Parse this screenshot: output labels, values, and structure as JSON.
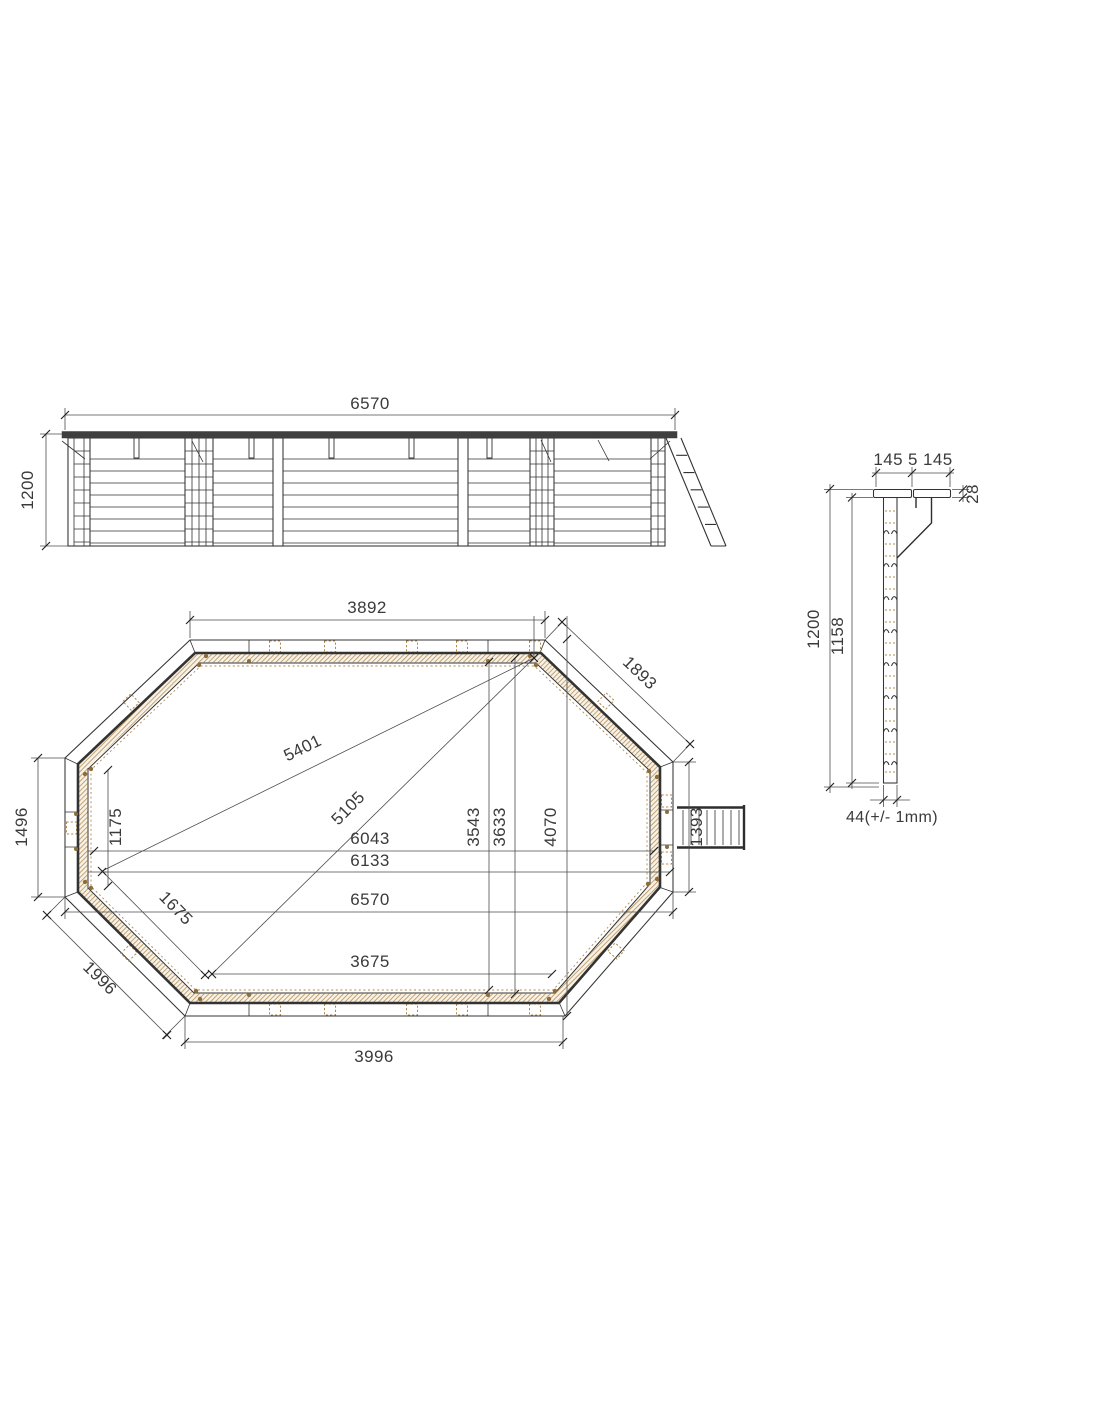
{
  "elevation": {
    "width": "6570",
    "height": "1200"
  },
  "plan": {
    "top_width": "3892",
    "top_right_edge": "1893",
    "left_height": "1496",
    "bottom_left_edge": "1996",
    "bottom_width": "3996",
    "inner_bottom_width": "3675",
    "length_inner": "6043",
    "length_mid": "6133",
    "length_outer": "6570",
    "diagonal_long": "5401",
    "diagonal_short": "5105",
    "left_inner_height": "1175",
    "corner_diagonal": "1675",
    "height_a": "3543",
    "height_b": "3633",
    "height_c": "4070",
    "ladder_width": "1393"
  },
  "section": {
    "coping_widths": "145 5 145",
    "coping_thickness": "28",
    "height_total": "1200",
    "height_wall": "1158",
    "plank_thickness": "44(+/- 1mm)"
  },
  "colors": {
    "ink": "#333333",
    "dimc": "#4d4d4d",
    "wood": "#b08a52",
    "wood2": "#8f6c3a",
    "rail": "#3f3f3f"
  }
}
